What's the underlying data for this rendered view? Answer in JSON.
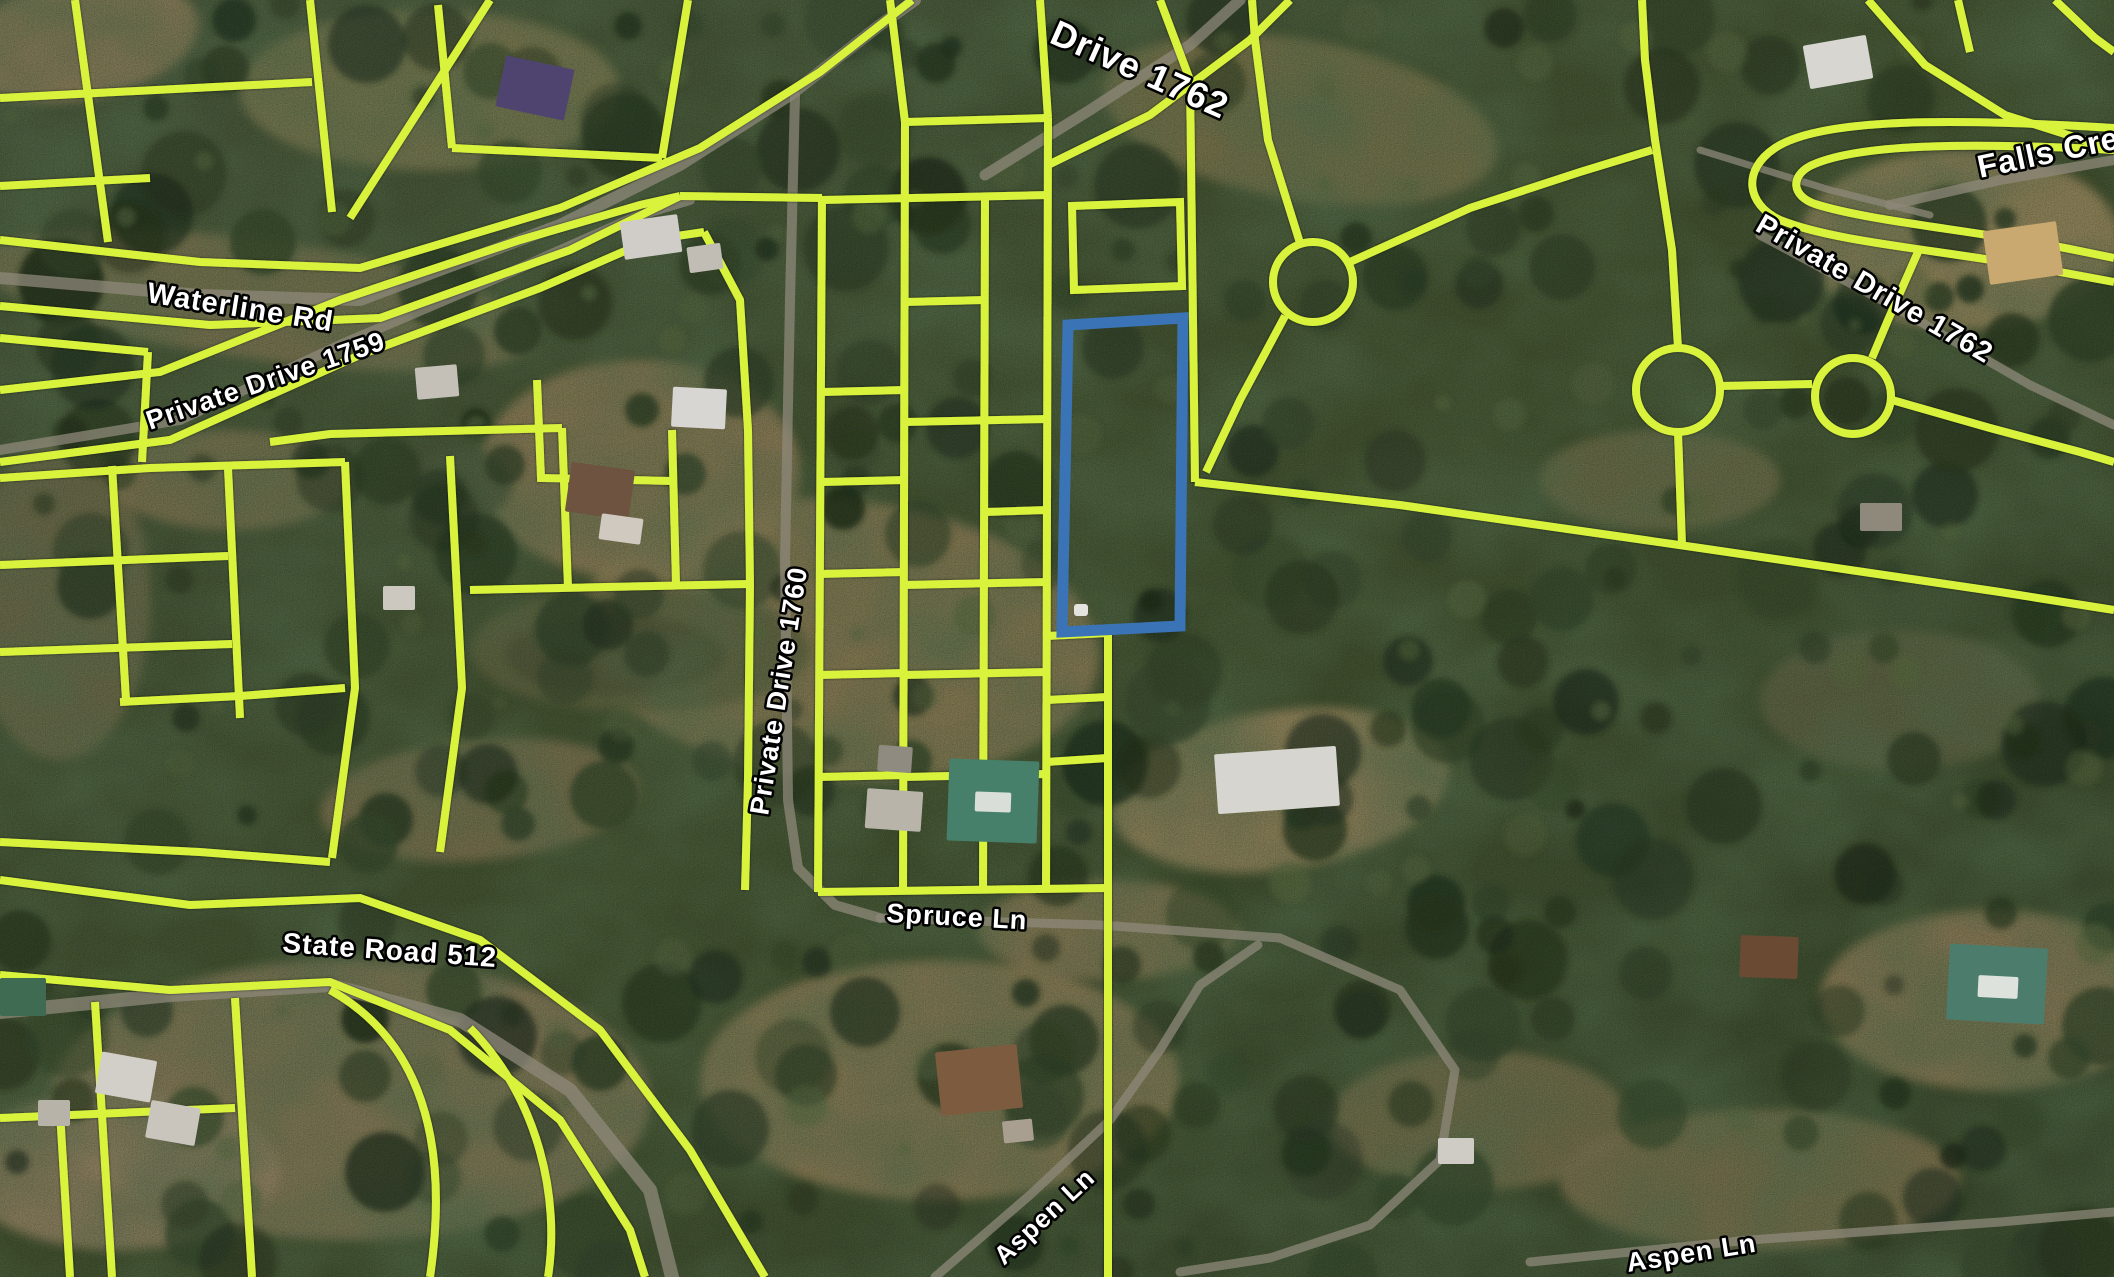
{
  "map": {
    "width": 2114,
    "height": 1277,
    "colors": {
      "parcel_line": "#d9f33d",
      "selected_parcel": "#3a74b6",
      "road": "#8e887a",
      "label_fill": "#ffffff",
      "label_stroke": "#000000",
      "terrain_base": "#41502f",
      "terrain_dark": "#2a3a22",
      "clearing": "#8a7b55"
    },
    "road_labels": [
      {
        "id": "drive-1762-top",
        "text": "Drive 1762",
        "x": 1048,
        "y": 42,
        "rotate": 24,
        "size": 36
      },
      {
        "id": "falls-creek",
        "text": "Falls Creek",
        "x": 1980,
        "y": 178,
        "rotate": -12,
        "size": 32
      },
      {
        "id": "private-drive-1762",
        "text": "Private Drive 1762",
        "x": 1754,
        "y": 230,
        "rotate": 30,
        "size": 29
      },
      {
        "id": "waterline-rd",
        "text": "Waterline Rd",
        "x": 146,
        "y": 302,
        "rotate": 9,
        "size": 29
      },
      {
        "id": "private-drive-1759",
        "text": "Private Drive 1759",
        "x": 150,
        "y": 430,
        "rotate": -19,
        "size": 27
      },
      {
        "id": "private-drive-1760",
        "text": "Private Drive 1760",
        "x": 768,
        "y": 816,
        "rotate": -81,
        "size": 27
      },
      {
        "id": "state-road-512",
        "text": "State Road 512",
        "x": 282,
        "y": 952,
        "rotate": 4,
        "size": 28
      },
      {
        "id": "spruce-ln",
        "text": "Spruce Ln",
        "x": 886,
        "y": 922,
        "rotate": 3,
        "size": 27
      },
      {
        "id": "aspen-ln-left",
        "text": "Aspen Ln",
        "x": 1004,
        "y": 1266,
        "rotate": -43,
        "size": 26
      },
      {
        "id": "aspen-ln-right",
        "text": "Aspen Ln",
        "x": 1628,
        "y": 1272,
        "rotate": -9,
        "size": 27
      }
    ],
    "selected_parcel": {
      "points": "1068,325 1183,318 1180,626 1062,632",
      "marker": {
        "x": 1074,
        "y": 604,
        "w": 14,
        "h": 12
      }
    },
    "parcel_lines": [
      {
        "t": "poly",
        "p": "75,0 108,242"
      },
      {
        "t": "poly",
        "p": "310,0 332,212"
      },
      {
        "t": "poly",
        "p": "490,0 350,218"
      },
      {
        "t": "poly",
        "p": "0,98 312,82"
      },
      {
        "t": "poly",
        "p": "0,186 150,178"
      },
      {
        "t": "poly",
        "p": "438,5 452,148"
      },
      {
        "t": "poly",
        "p": "452,148 662,158"
      },
      {
        "t": "poly",
        "p": "662,158 688,0"
      },
      {
        "t": "poly",
        "p": "0,240 200,262 360,268 560,208 700,148 820,72 912,0"
      },
      {
        "t": "poly",
        "p": "0,306 210,325 380,318 570,250 680,196"
      },
      {
        "t": "poly",
        "p": "680,196 822,198"
      },
      {
        "t": "poly",
        "p": "0,390 160,372 340,300 520,240 640,205 680,196"
      },
      {
        "t": "poly",
        "p": "0,462 170,440 360,355 540,288 650,240 704,232"
      },
      {
        "t": "poly",
        "p": "704,232 740,300 748,430 750,585 748,780 745,890"
      },
      {
        "t": "poly",
        "p": "0,478 150,468 345,462"
      },
      {
        "t": "poly",
        "p": "270,442 330,434 562,428"
      },
      {
        "t": "poly",
        "p": "562,428 568,588"
      },
      {
        "t": "poly",
        "p": "470,590 748,584"
      },
      {
        "t": "poly",
        "p": "672,430 676,584"
      },
      {
        "t": "poly",
        "p": "537,380 541,478 672,481"
      },
      {
        "t": "poly",
        "p": "112,466 126,700"
      },
      {
        "t": "poly",
        "p": "228,468 240,718"
      },
      {
        "t": "poly",
        "p": "0,565 228,556"
      },
      {
        "t": "poly",
        "p": "0,652 232,644"
      },
      {
        "t": "poly",
        "p": "120,702 240,696 345,688"
      },
      {
        "t": "poly",
        "p": "345,462 355,688 332,858"
      },
      {
        "t": "poly",
        "p": "450,456 462,688 440,852"
      },
      {
        "t": "poly",
        "p": "0,338 148,352"
      },
      {
        "t": "poly",
        "p": "148,352 142,462"
      },
      {
        "t": "poly",
        "p": "0,880 190,905 360,898 480,940 600,1030 690,1150 765,1277"
      },
      {
        "t": "poly",
        "p": "0,975 170,990 330,982 450,1030 560,1120 630,1230 645,1277"
      },
      {
        "t": "poly",
        "p": "95,1002 112,1277"
      },
      {
        "t": "poly",
        "p": "235,998 252,1277"
      },
      {
        "t": "path",
        "p": "M330,990 C420,1040 450,1140 430,1277"
      },
      {
        "t": "path",
        "p": "M470,1028 C540,1100 560,1200 548,1277"
      },
      {
        "t": "poly",
        "p": "0,1118 235,1108"
      },
      {
        "t": "poly",
        "p": "60,1112 70,1277"
      },
      {
        "t": "poly",
        "p": "0,842 200,852 330,862"
      },
      {
        "t": "poly",
        "p": "822,196 818,892"
      },
      {
        "t": "poly",
        "p": "905,122 903,892"
      },
      {
        "t": "poly",
        "p": "985,196 983,892"
      },
      {
        "t": "poly",
        "p": "1048,118 1046,892"
      },
      {
        "t": "poly",
        "p": "822,200 1048,195"
      },
      {
        "t": "poly",
        "p": "905,122 1048,118"
      },
      {
        "t": "poly",
        "p": "890,0 905,122"
      },
      {
        "t": "poly",
        "p": "1040,0 1048,118"
      },
      {
        "t": "poly",
        "p": "822,392 905,390"
      },
      {
        "t": "poly",
        "p": "822,482 905,480"
      },
      {
        "t": "poly",
        "p": "818,574 905,572"
      },
      {
        "t": "poly",
        "p": "818,675 905,673"
      },
      {
        "t": "poly",
        "p": "818,777 905,775"
      },
      {
        "t": "poly",
        "p": "905,302 985,300"
      },
      {
        "t": "poly",
        "p": "905,422 1048,419"
      },
      {
        "t": "poly",
        "p": "903,585 1048,582"
      },
      {
        "t": "poly",
        "p": "903,675 1048,672"
      },
      {
        "t": "poly",
        "p": "903,777 1048,774"
      },
      {
        "t": "poly",
        "p": "985,512 1048,510"
      },
      {
        "t": "poly",
        "p": "818,892 1108,888"
      },
      {
        "t": "poly",
        "p": "1108,630 1108,1277"
      },
      {
        "t": "poly",
        "p": "1046,636 1108,633"
      },
      {
        "t": "poly",
        "p": "1046,700 1108,697"
      },
      {
        "t": "poly",
        "p": "1046,762 1108,758"
      },
      {
        "t": "path",
        "p": "M1072,206 L1180,202 L1182,286 L1074,290 Z"
      },
      {
        "t": "poly",
        "p": "1048,165 1150,115 1250,40 1290,0"
      },
      {
        "t": "poly",
        "p": "1160,0 1190,80 1195,482"
      },
      {
        "t": "poly",
        "p": "1195,482 1400,505 1700,548 2000,592 2114,610"
      },
      {
        "t": "circle",
        "cx": 1313,
        "cy": 282,
        "r": 40
      },
      {
        "t": "poly",
        "p": "1300,243 1268,140 1255,40 1252,0"
      },
      {
        "t": "poly",
        "p": "1350,262 1470,208 1580,172 1652,150"
      },
      {
        "t": "poly",
        "p": "1285,316 1240,400 1206,472"
      },
      {
        "t": "circle",
        "cx": 1678,
        "cy": 390,
        "r": 42
      },
      {
        "t": "poly",
        "p": "1678,348 1672,250 1655,140 1645,60 1642,0"
      },
      {
        "t": "poly",
        "p": "1678,432 1682,545"
      },
      {
        "t": "poly",
        "p": "1720,386 1812,384"
      },
      {
        "t": "circle",
        "cx": 1853,
        "cy": 396,
        "r": 38
      },
      {
        "t": "poly",
        "p": "1892,400 1990,428 2080,452 2114,462"
      },
      {
        "t": "poly",
        "p": "1918,252 1888,320 1872,358"
      },
      {
        "t": "path",
        "p": "M2114,128 C1950,118 1820,118 1775,148 C1742,170 1746,204 1780,220 C1840,244 1950,250 2060,272 L2114,282"
      },
      {
        "t": "path",
        "p": "M2114,150 C1965,142 1855,144 1810,166 C1790,177 1792,196 1815,204 C1872,222 1975,230 2075,250 L2114,258"
      },
      {
        "t": "poly",
        "p": "1868,0 1925,65 2005,115 2090,142 2114,148"
      },
      {
        "t": "poly",
        "p": "2055,0 2095,38 2114,52"
      },
      {
        "t": "poly",
        "p": "1958,0 1970,52"
      }
    ],
    "roads": [
      {
        "w": 12,
        "p": "M0,278 L200,295 L360,300 L560,225 L680,165 L790,95 L880,25 L915,0"
      },
      {
        "w": 11,
        "p": "M985,175 L1090,110 L1190,45 L1240,0"
      },
      {
        "w": 10,
        "p": "M0,450 L180,420 L340,345 L520,268 L640,215 L690,200"
      },
      {
        "w": 10,
        "p": "M795,95 L790,300 L785,560 L788,800 L798,868 L835,905 L880,918"
      },
      {
        "w": 9,
        "p": "M880,918 L1100,925 L1280,938 L1400,990 L1455,1070 L1440,1160 L1370,1225 L1270,1258 L1180,1272"
      },
      {
        "w": 9,
        "p": "M935,1277 L1030,1195 L1110,1120 L1160,1050 L1200,985 L1258,945"
      },
      {
        "w": 9,
        "p": "M1530,1262 L1750,1240 L2000,1222 L2114,1212"
      },
      {
        "w": 14,
        "p": "M0,1012 L170,995 L330,985 L460,1020 L570,1090 L650,1190 L672,1277"
      },
      {
        "w": 10,
        "p": "M1890,205 L2000,180 L2114,160"
      },
      {
        "w": 9,
        "p": "M1760,235 L1900,310 L2030,385 L2114,425"
      },
      {
        "w": 7,
        "p": "M1700,150 L1830,190 L1930,215"
      }
    ],
    "houses": [
      {
        "name": "purple-roof-house",
        "x": 500,
        "y": 62,
        "w": 70,
        "h": 52,
        "rot": 12,
        "c": "#4f4470"
      },
      {
        "name": "white-shed",
        "x": 622,
        "y": 218,
        "w": 58,
        "h": 38,
        "rot": -8,
        "c": "#d0cdc8"
      },
      {
        "name": "white-shed",
        "x": 688,
        "y": 245,
        "w": 34,
        "h": 26,
        "rot": -8,
        "c": "#c2bdb4"
      },
      {
        "name": "white-house",
        "x": 672,
        "y": 388,
        "w": 54,
        "h": 40,
        "rot": 3,
        "c": "#d8d6d2"
      },
      {
        "name": "brown-roof-house",
        "x": 568,
        "y": 466,
        "w": 64,
        "h": 50,
        "rot": 8,
        "c": "#6e5340"
      },
      {
        "name": "porch",
        "x": 600,
        "y": 516,
        "w": 42,
        "h": 26,
        "rot": 8,
        "c": "#cfc9c0"
      },
      {
        "name": "teal-roof-house",
        "x": 948,
        "y": 760,
        "w": 90,
        "h": 82,
        "rot": 2,
        "c": "#46806a"
      },
      {
        "name": "teal-roof-trim",
        "x": 975,
        "y": 792,
        "w": 36,
        "h": 20,
        "rot": 2,
        "c": "#d9ded9"
      },
      {
        "name": "grey-shed",
        "x": 866,
        "y": 790,
        "w": 56,
        "h": 40,
        "rot": 4,
        "c": "#b9b4aa"
      },
      {
        "name": "grey-shed",
        "x": 878,
        "y": 746,
        "w": 34,
        "h": 26,
        "rot": 4,
        "c": "#8f8b80"
      },
      {
        "name": "brown-roof-house",
        "x": 938,
        "y": 1048,
        "w": 82,
        "h": 64,
        "rot": -6,
        "c": "#7d5b3f"
      },
      {
        "name": "shed",
        "x": 1003,
        "y": 1120,
        "w": 30,
        "h": 22,
        "rot": -6,
        "c": "#a99f90"
      },
      {
        "name": "white-industrial-building",
        "x": 1216,
        "y": 750,
        "w": 122,
        "h": 60,
        "rot": -4,
        "c": "#d7d5d0"
      },
      {
        "name": "teal-roof-house",
        "x": 1948,
        "y": 946,
        "w": 98,
        "h": 76,
        "rot": 3,
        "c": "#4c7d6c"
      },
      {
        "name": "teal-roof-trim",
        "x": 1978,
        "y": 976,
        "w": 40,
        "h": 22,
        "rot": 3,
        "c": "#dde2dd"
      },
      {
        "name": "brown-cabin",
        "x": 1740,
        "y": 936,
        "w": 58,
        "h": 42,
        "rot": 2,
        "c": "#6b4a33"
      },
      {
        "name": "grey-shed",
        "x": 1860,
        "y": 503,
        "w": 42,
        "h": 28,
        "rot": 0,
        "c": "#8f897c"
      },
      {
        "name": "white-shed",
        "x": 1438,
        "y": 1138,
        "w": 36,
        "h": 26,
        "rot": 0,
        "c": "#cfccc6"
      },
      {
        "name": "white-house",
        "x": 1806,
        "y": 40,
        "w": 64,
        "h": 44,
        "rot": -10,
        "c": "#d8d6d0"
      },
      {
        "name": "tan-a-frame-house",
        "x": 1986,
        "y": 226,
        "w": 74,
        "h": 54,
        "rot": -8,
        "c": "#c9a96f"
      },
      {
        "name": "green-roof-house",
        "x": 0,
        "y": 978,
        "w": 46,
        "h": 38,
        "rot": 0,
        "c": "#3f6b52"
      },
      {
        "name": "white-house",
        "x": 98,
        "y": 1056,
        "w": 56,
        "h": 42,
        "rot": 10,
        "c": "#d2cfc9"
      },
      {
        "name": "white-house",
        "x": 148,
        "y": 1104,
        "w": 50,
        "h": 38,
        "rot": 10,
        "c": "#c9c5bd"
      },
      {
        "name": "grey-shed",
        "x": 38,
        "y": 1100,
        "w": 32,
        "h": 26,
        "rot": 0,
        "c": "#b8b3a8"
      },
      {
        "name": "white-shed",
        "x": 383,
        "y": 586,
        "w": 32,
        "h": 24,
        "rot": 0,
        "c": "#ccc8c0"
      },
      {
        "name": "grey-building",
        "x": 416,
        "y": 366,
        "w": 42,
        "h": 32,
        "rot": -5,
        "c": "#c4c0b8"
      }
    ],
    "ponds": [
      {
        "cx": 444,
        "cy": 486,
        "rx": 68,
        "ry": 40,
        "c": "#454f33"
      },
      {
        "cx": 640,
        "cy": 650,
        "rx": 170,
        "ry": 62,
        "c": "#5d5f3e"
      },
      {
        "cx": 615,
        "cy": 655,
        "rx": 110,
        "ry": 40,
        "c": "#4f5134"
      }
    ],
    "clearings": [
      {
        "cx": 80,
        "cy": 40,
        "rx": 120,
        "ry": 60,
        "rot": -10,
        "c": "#8f7f5c"
      },
      {
        "cx": 430,
        "cy": 90,
        "rx": 190,
        "ry": 80,
        "rot": 0,
        "c": "#7d7a52"
      },
      {
        "cx": 260,
        "cy": 300,
        "rx": 280,
        "ry": 60,
        "rot": 8,
        "c": "#7b7452"
      },
      {
        "cx": 640,
        "cy": 470,
        "rx": 160,
        "ry": 110,
        "rot": 0,
        "c": "#8d7d58"
      },
      {
        "cx": 840,
        "cy": 640,
        "rx": 260,
        "ry": 140,
        "rot": 5,
        "c": "#8a7b55"
      },
      {
        "cx": 940,
        "cy": 1080,
        "rx": 240,
        "ry": 120,
        "rot": 0,
        "c": "#8d7e57"
      },
      {
        "cx": 350,
        "cy": 1100,
        "rx": 300,
        "ry": 140,
        "rot": 0,
        "c": "#87795a"
      },
      {
        "cx": 120,
        "cy": 1170,
        "rx": 160,
        "ry": 80,
        "rot": 0,
        "c": "#8f8060"
      },
      {
        "cx": 1280,
        "cy": 790,
        "rx": 170,
        "ry": 80,
        "rot": -8,
        "c": "#94855e"
      },
      {
        "cx": 1990,
        "cy": 1000,
        "rx": 170,
        "ry": 90,
        "rot": 0,
        "c": "#8c7d57"
      },
      {
        "cx": 1760,
        "cy": 1180,
        "rx": 200,
        "ry": 70,
        "rot": 0,
        "c": "#7f7350"
      },
      {
        "cx": 1960,
        "cy": 240,
        "rx": 160,
        "ry": 90,
        "rot": 0,
        "c": "#97865e"
      },
      {
        "cx": 1300,
        "cy": 120,
        "rx": 200,
        "ry": 80,
        "rot": 10,
        "c": "#7a744e"
      },
      {
        "cx": 1660,
        "cy": 480,
        "rx": 120,
        "ry": 50,
        "rot": 0,
        "c": "#6f6b48"
      },
      {
        "cx": 480,
        "cy": 800,
        "rx": 160,
        "ry": 60,
        "rot": -5,
        "c": "#7d7150"
      },
      {
        "cx": 1108,
        "cy": 930,
        "rx": 130,
        "ry": 50,
        "rot": 0,
        "c": "#857a56"
      },
      {
        "cx": 60,
        "cy": 600,
        "rx": 90,
        "ry": 160,
        "rot": 0,
        "c": "#6e6a4a"
      },
      {
        "cx": 1900,
        "cy": 700,
        "rx": 140,
        "ry": 70,
        "rot": 0,
        "c": "#5e6243"
      },
      {
        "cx": 1480,
        "cy": 1120,
        "rx": 150,
        "ry": 70,
        "rot": 0,
        "c": "#76704e"
      },
      {
        "cx": 230,
        "cy": 480,
        "rx": 120,
        "ry": 50,
        "rot": 0,
        "c": "#7c7452"
      }
    ]
  }
}
